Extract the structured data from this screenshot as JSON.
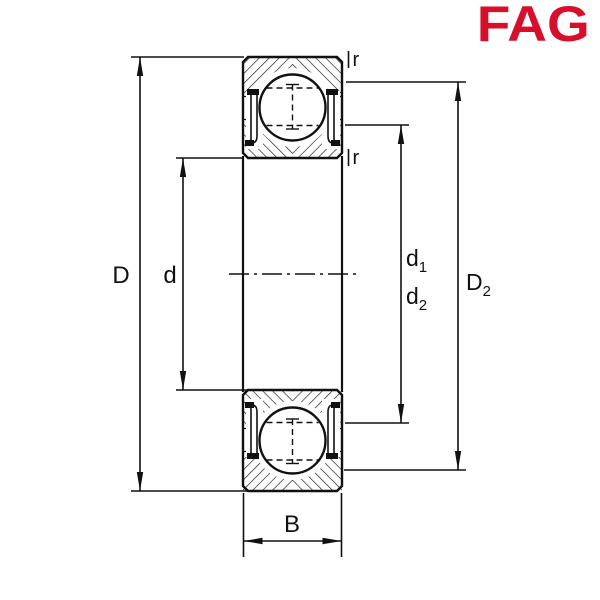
{
  "page": {
    "background": "#ffffff"
  },
  "logo": {
    "text": "FAG",
    "color": "#D6102C"
  },
  "diagram": {
    "kind": "ball-bearing-cross-section",
    "line_color": "#111111",
    "labels": {
      "D": "D",
      "d": "d",
      "B": "B",
      "d1_base": "d",
      "d1_sub": "1",
      "d2_base": "d",
      "d2_sub": "2",
      "D2_base": "D",
      "D2_sub": "2",
      "r_top": "r",
      "r_bottom": "r"
    }
  }
}
